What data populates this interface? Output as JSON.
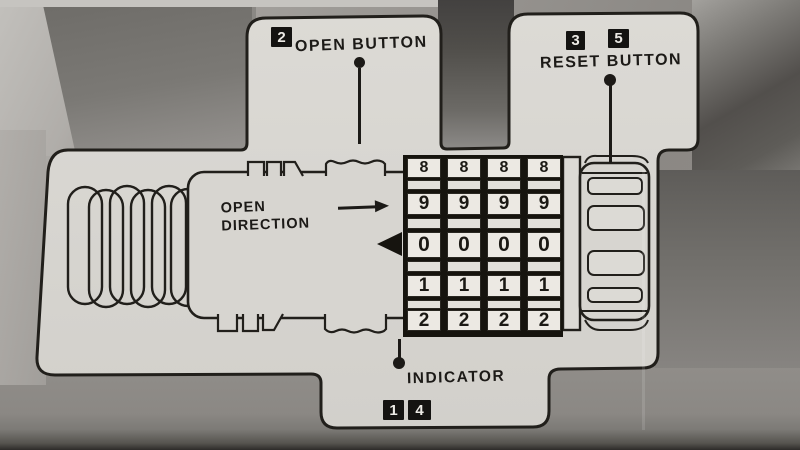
{
  "diagram": {
    "kind": "combination-lock-instruction-diagram",
    "callouts": {
      "open_button": {
        "label": "OPEN BUTTON",
        "step_refs": [
          "2"
        ]
      },
      "reset_button": {
        "label": "RESET BUTTON",
        "step_refs": [
          "3",
          "5"
        ]
      },
      "indicator": {
        "label": "INDICATOR",
        "step_refs": [
          "1",
          "4"
        ]
      },
      "open_direction": {
        "label_line1": "OPEN",
        "label_line2": "DIRECTION"
      }
    },
    "dial": {
      "visible_code_row": "0 0 0 0",
      "rows": [
        {
          "digits": [
            "8",
            "8",
            "8",
            "8"
          ]
        },
        {
          "digits": [
            "9",
            "9",
            "9",
            "9"
          ]
        },
        {
          "digits": [
            "0",
            "0",
            "0",
            "0"
          ],
          "indicated": true
        },
        {
          "digits": [
            "1",
            "1",
            "1",
            "1"
          ]
        },
        {
          "digits": [
            "2",
            "2",
            "2",
            "2"
          ]
        }
      ]
    },
    "colors": {
      "panel": "#d8d6d1",
      "outline": "#211f1b",
      "tile": "#ece9e3",
      "ink": "#1c1a17",
      "photo_shadow": "#504e4a"
    }
  }
}
